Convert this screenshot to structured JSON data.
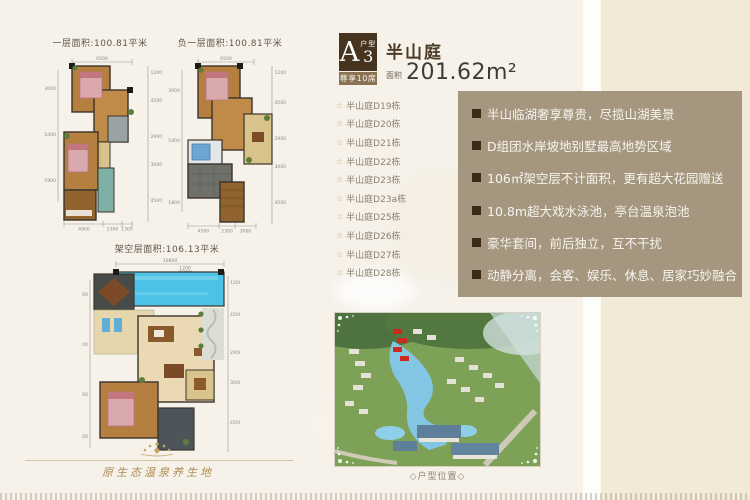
{
  "header": {
    "type_letter": "A",
    "type_number": "3",
    "type_label": "户型",
    "exclusive_label": "尊享10席",
    "estate_name": "半山庭",
    "area_label": "面积",
    "area_value": "201.62m²"
  },
  "plans": [
    {
      "title": "一层面积:100.81平米",
      "dims": {
        "top": "6500",
        "left": [
          "3000",
          "5400",
          "5900"
        ],
        "right": [
          "1200",
          "4500",
          "2900",
          "3000",
          "4500"
        ],
        "bottom": [
          "4900",
          "2300",
          "1300"
        ]
      }
    },
    {
      "title": "负一层面积:100.81平米",
      "dims": {
        "top": "6500",
        "left": [
          "3000",
          "5400",
          "1800"
        ],
        "right": [
          "1200",
          "4500",
          "2900",
          "3000",
          "4500"
        ],
        "bottom": [
          "4500",
          "2300",
          "3000"
        ]
      }
    },
    {
      "title": "架空层面积:106.13平米",
      "dims": {
        "top": "10800",
        "top_sub": "1200",
        "left": [
          "3000",
          "5400",
          "5900",
          "1800"
        ],
        "right": [
          "1200",
          "4500",
          "2900",
          "3000",
          "4500"
        ]
      }
    }
  ],
  "buildings": [
    "半山庭D19栋",
    "半山庭D20栋",
    "半山庭D21栋",
    "半山庭D22栋",
    "半山庭D23栋",
    "半山庭D23a栋",
    "半山庭D25栋",
    "半山庭D26栋",
    "半山庭D27栋",
    "半山庭D28栋"
  ],
  "list_star_glyph": "☆",
  "features": [
    "半山临湖奢享尊贵，尽揽山湖美景",
    "D组团水岸坡地别墅最高地势区域",
    "106㎡架空层不计面积，更有超大花园赠送",
    "10.8m超大戏水泳池，亭台温泉泡池",
    "豪华套间，前后独立，互不干扰",
    "动静分离，会客、娱乐、休息、居家巧妙融合"
  ],
  "site_caption": "◇户型位置◇",
  "footer_slogan": "原生态温泉养生地",
  "colors": {
    "panel_taupe": "#a59680",
    "badge_brown": "#46341e",
    "badge_strip": "#8a7354",
    "accent_gold": "#ad8c55",
    "cream_right": "#f3e9d7",
    "pool_blue": "#4cc2e8",
    "location_red": "#cc2a20"
  }
}
